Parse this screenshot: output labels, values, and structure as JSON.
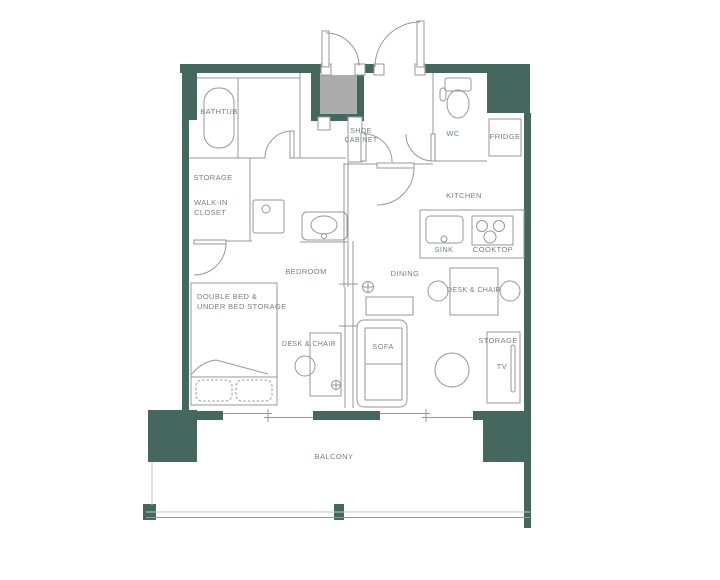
{
  "colors": {
    "wall": "#44685D",
    "niche": "#ACACAC",
    "line": "#979797",
    "lite": "#C6C6C6",
    "label": "#74837D"
  },
  "labels": {
    "bathtub": "BATHTUB",
    "storage_closet": "STORAGE",
    "walk_in_closet": "WALK-IN\nCLOSET",
    "shoe_cabinet": "SHOE\nCABINET",
    "wc": "WC",
    "fridge": "FRIDGE",
    "kitchen": "KITCHEN",
    "sink": "SINK",
    "cooktop": "COOKTOP",
    "dining": "DINING",
    "dining_desk_chair": "DESK & CHAIR",
    "bedroom": "BEDROOM",
    "double_bed": "DOUBLE BED &\nUNDER BED STORAGE",
    "bedroom_desk_chair": "DESK & CHAIR",
    "sofa": "SOFA",
    "storage_living": "STORAGE",
    "tv": "TV",
    "balcony": "BALCONY"
  }
}
